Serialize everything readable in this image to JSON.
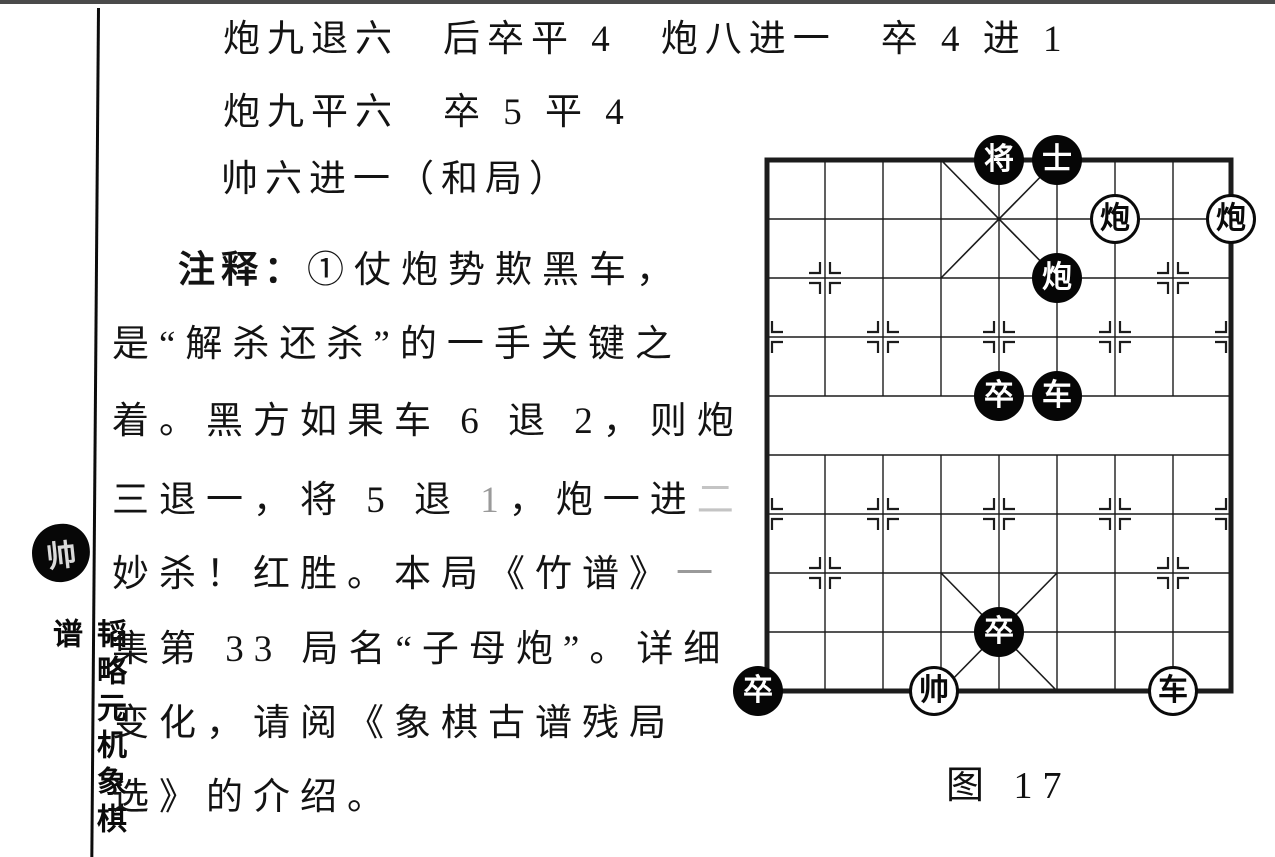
{
  "sidebar": {
    "seal_char": "帅",
    "vertical_title": "韬略元机象棋谱"
  },
  "moves": {
    "line1": "炮九退六　后卒平 4　炮八进一　卒 4 进 1",
    "line2": "炮九平六　卒 5 平 4",
    "line3": "帅六进一（和局）"
  },
  "commentary": {
    "label": "注释：",
    "line1_rest": "①仗炮势欺黑车，",
    "line2": "是“解杀还杀”的一手关键之",
    "line3": "着。黑方如果车 6 退 2，则炮",
    "line4_a": "三退一，将 5 退 ",
    "line4_b": "1",
    "line4_c": "，炮一进",
    "line4_d": "二",
    "line5_a": "妙杀！红胜。本局《竹谱》",
    "line5_b": "一",
    "line6": "集第 33 局名“子母炮”。详细",
    "line7": "变化，请阅《象棋古谱残局",
    "line8": "选》的介绍。"
  },
  "figure": {
    "caption": "图 17"
  },
  "board": {
    "files": 9,
    "ranks": 10,
    "line_color": "#1c1c1c",
    "black_piece_color": "#060606",
    "red_piece_color": "#ffffff",
    "pieces": [
      {
        "label": "将",
        "side": "black",
        "file": 5,
        "rank": 0
      },
      {
        "label": "士",
        "side": "black",
        "file": 6,
        "rank": 0
      },
      {
        "label": "炮",
        "side": "red",
        "file": 7,
        "rank": 1
      },
      {
        "label": "炮",
        "side": "red",
        "file": 9,
        "rank": 1
      },
      {
        "label": "炮",
        "side": "black",
        "file": 6,
        "rank": 2
      },
      {
        "label": "卒",
        "side": "black",
        "file": 5,
        "rank": 4
      },
      {
        "label": "车",
        "side": "black",
        "file": 6,
        "rank": 4
      },
      {
        "label": "卒",
        "side": "black",
        "file": 5,
        "rank": 8
      },
      {
        "label": "卒",
        "side": "black",
        "file": 1,
        "rank": 9,
        "dx": -9
      },
      {
        "label": "帅",
        "side": "red",
        "file": 4,
        "rank": 9,
        "dx": -7
      },
      {
        "label": "车",
        "side": "red",
        "file": 8,
        "rank": 9
      }
    ]
  }
}
